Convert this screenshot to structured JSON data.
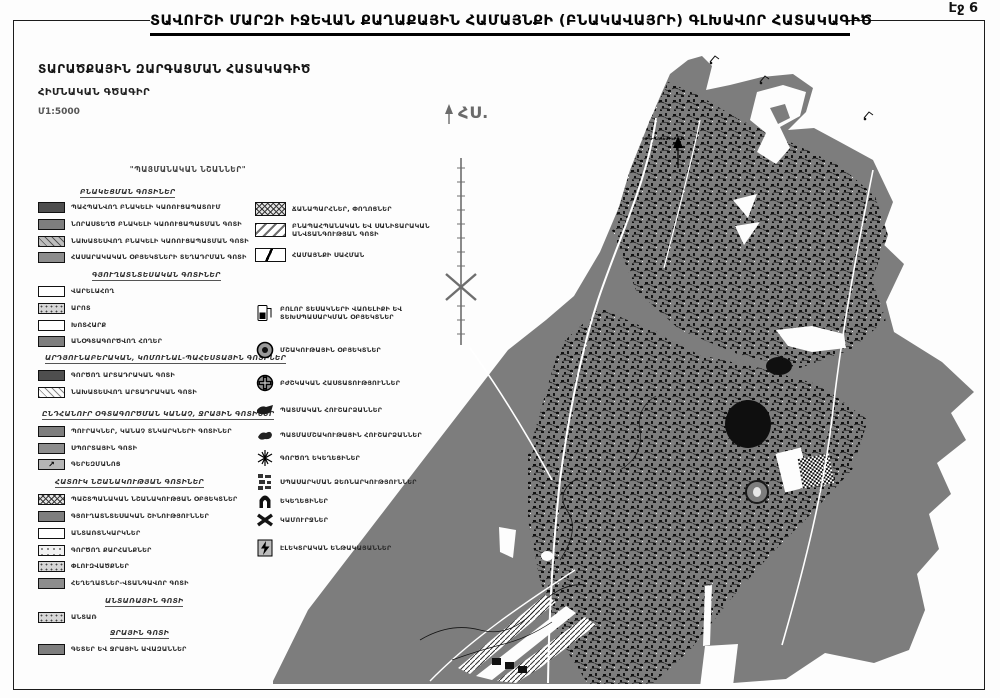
{
  "header": {
    "page_label": "Էջ 6",
    "title": "ՏԱՎՈՒՇԻ ՄԱՐԶԻ ԻՋԵՎԱՆ ՔԱՂԱՔԱՅԻՆ ՀԱՄԱՅՆՔԻ  (ԲՆԱԿԱՎԱՅՐԻ) ԳԼԽԱՎՈՐ ՀԱՏԱԿԱԳԻԾ",
    "subtitle1": "ՏԱՐԱԾՔԱՅԻՆ ԶԱՐԳԱՑՄԱՆ ՀԱՏԱԿԱԳԻԾ",
    "subtitle2": "ՀԻՄՆԱԿԱՆ ԳԾԱԳԻՐ",
    "scale": "Մ1:5000"
  },
  "legend": {
    "title": "\"ՊԱՅՄԱՆԱԿԱՆ ՆՇԱՆՆԵՐ\"",
    "sections": [
      {
        "header": "ԲՆԱԿԵՑՄԱՆ ԳՈՏԻՆԵՐ",
        "items": [
          {
            "label": "ՊԱՀՊԱՆՎՈՂ ԲՆԱԿԵԼԻ ԿԱՌՈՒՑԱՊԱՏՈՒՄ"
          },
          {
            "label": "ՆՈՐԱՍՏԵՂԾ ԲՆԱԿԵԼԻ ԿԱՌՈՒՑԱՊԱՏՄԱՆ ԳՈՏԻ"
          },
          {
            "label": "ՆԱԽԱՏԵՍՎՈՂ ԲՆԱԿԵԼԻ ԿԱՌՈՒՑԱՊԱՏՄԱՆ ԳՈՏԻ"
          },
          {
            "label": "ՀԱՍԱՐԱԿԱԿԱՆ ՕԲՅԵԿՏՆԵՐԻ ՏԵՂԱԴՐՄԱՆ ԳՈՏԻ"
          }
        ]
      },
      {
        "header": "ԳՅՈՒՂԱՏՆՏԵՍԱԿԱՆ ԳՈՏԻՆԵՐ",
        "items": [
          {
            "label": "ՎԱՐԵԼԱՀՈՂ"
          },
          {
            "label": "ԱՐՈՏ"
          },
          {
            "label": "ԽՈՏՀԱՐՔ"
          },
          {
            "label": "ԱՆՕԳՏԱԳՈՐԾՎՈՂ ՀՈՂԵՐ"
          }
        ]
      },
      {
        "header": "ԱՐԴՅՈՒՆԱԲԵՐԱԿԱՆ, ԿՈՄՈՒՆԱԼ-ՊԱՀԵՍՏԱՅԻՆ ԳՈՏԻՆԵՐ",
        "items": [
          {
            "label": "ԳՈՐԾՈՂ ԱՐՏԱԴՐԱԿԱՆ ԳՈՏԻ"
          },
          {
            "label": "ՆԱԽԱՏԵՍՎՈՂ ԱՐՏԱԴՐԱԿԱՆ ԳՈՏԻ"
          }
        ]
      },
      {
        "header": "ԸՆԴՀԱՆՈՒՐ ՕԳՏԱԳՈՐԾՄԱՆ ԿԱՆԱՉ, ՋՐԱՅԻՆ ԳՈՏԻՆԵՐ",
        "items": [
          {
            "label": "ՊՈՒՐԱԿՆԵՐ, ԿԱՆԱՉ ՏՆԿԱՐԿՆԵՐԻ ԳՈՏԻՆԵՐ"
          },
          {
            "label": "ՍՊՈՐՏԱՅԻՆ ԳՈՏԻ"
          },
          {
            "label": "ԳԵՐԵԶՄԱՆՈՑ"
          }
        ]
      },
      {
        "header": "ՀԱՏՈՒԿ ՆՇԱՆԱԿՈՒԹՅԱՆ ԳՈՏԻՆԵՐ",
        "items": [
          {
            "label": "ՊԱՇՏՊԱՆԱԿԱՆ ՆՇԱՆԱԿՈՒԹՅԱՆ ՕԲՅԵԿՏՆԵՐ"
          },
          {
            "label": "ԳՅՈՒՂԱՏՆՏԵՍԱԿԱՆ ՇԻՆՈՒԹՅՈՒՆՆԵՐ"
          },
          {
            "label": "ԱՆՏԱՌՏՆԿԱՐԿՆԵՐ"
          },
          {
            "label": "ԳՈՐԾՈՂ ՔԱՐՀԱՆՔՆԵՐ"
          },
          {
            "label": "ՓԼՈՒԶՎԱԾՔՆԵՐ"
          },
          {
            "label": "ՀԵՂԵՂԱՏՆԵՐ-ՎՏԱՆԳԱՎՈՐ ԳՈՏԻ"
          }
        ]
      },
      {
        "header": "ԱՆՏԱՌԱՅԻՆ ԳՈՏԻ",
        "items": [
          {
            "label": "ԱՆՏԱՌ"
          }
        ]
      },
      {
        "header": "ՋՐԱՅԻՆ ԳՈՏԻ",
        "items": [
          {
            "label": "ԳԵՏԵՐ ԵՎ ՋՐԱՅԻՆ ԱՎԱԶԱՆՆԵՐ"
          }
        ]
      }
    ],
    "linework": [
      {
        "label": "ՃԱՆԱՊԱՐՀՆԵՐ, ՓՈՂՈՑՆԵՐ"
      },
      {
        "label": "ԲՆԱՊԱՀՊԱՆԱԿԱՆ ԵՎ ՍԱՆԻՏԱՐԱԿԱՆ ԱՆՎՏԱՆԳՈՒԹՅԱՆ ԳՈՏԻ"
      },
      {
        "label": "ՀԱՄԱՅՆՔԻ ՍԱՀՄԱՆ"
      }
    ],
    "symbols": [
      {
        "label": "ԲՈԼՈՐ ՏԵՍԱԿՆԵՐԻ ՎԱՌԵԼԻՔԻ ԵՎ ՏԵԽՍՊԱՍԱՐԿՄԱՆ ՕԲՅԵԿՏՆԵՐ"
      },
      {
        "label": "ՄՇԱԿՈՒԹԱՅԻՆ ՕԲՅԵԿՏՆԵՐ"
      },
      {
        "label": "ԲԺՇԿԱԿԱՆ ՀԱՍՏԱՏՈՒԹՅՈՒՆՆԵՐ"
      },
      {
        "label": "ՊԱՏՄԱԿԱՆ ՀՈՒՇԱՐՁԱՆՆԵՐ"
      },
      {
        "label": "ՊԱՏՄԱՄՇԱԿՈՒԹԱՅԻՆ ՀՈՒՇԱՐՁԱՆՆԵՐ"
      },
      {
        "label": "ԳՈՐԾՈՂ ԵԿԵՂԵՑԻՆԵՐ"
      },
      {
        "label": "ՍՊԱՍԱՐԿՄԱՆ ՁԵՌՆԱՐԿՈՒԹՅՈՒՆՆԵՐ"
      },
      {
        "label": "ԵԿԵՂԵՑԻՆԵՐ"
      },
      {
        "label": "ԿԱՄՈՒՐՋՆԵՐ"
      },
      {
        "label": "ԷԼԵԿՏՐԱԿԱՆ ԵՆԹԱԿԱՅԱՆՆԵՐ"
      }
    ],
    "cemetery_arrow_glyph": "↗"
  },
  "map": {
    "north_label": "ՀՍ.",
    "direction_label": "ԴԵՊԻ ՆՈՅԵՄԲԵՐՅԱՆ",
    "colors": {
      "land": "#7d7d7d",
      "urban_ink": "#101010",
      "road": "#ffffff"
    }
  }
}
